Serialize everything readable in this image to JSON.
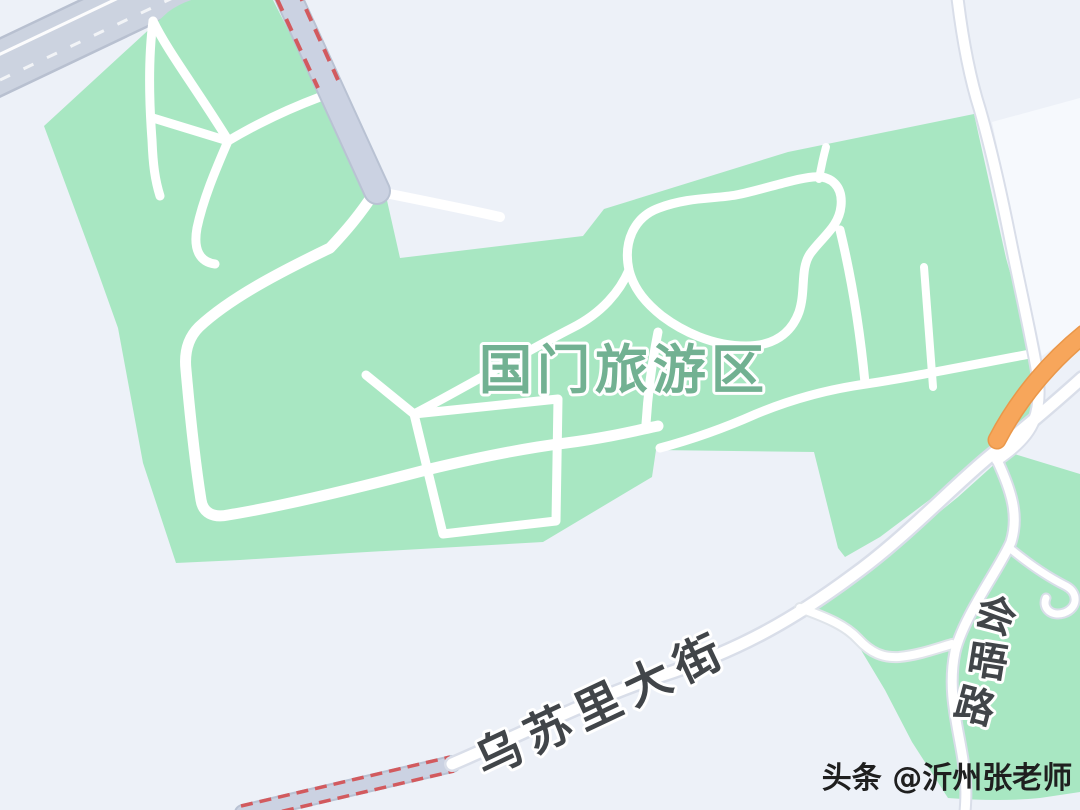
{
  "map": {
    "area_label": "国门旅游区",
    "streets": {
      "main_street": "乌苏里大街",
      "side_street": "会晤路",
      "side_street_chars": [
        "会",
        "晤",
        "路"
      ]
    },
    "watermark": "头条 @沂州张老师",
    "features": {
      "park": "tourist-area-green-zone",
      "border_strip": "red-dashed-boundary-road",
      "highway_segment": "orange-road-segment",
      "big_road": "gray-road-top-left"
    },
    "colors": {
      "background": "#edf1f8",
      "park_green": "#a8e7c2",
      "area_label_green": "#72b192",
      "street_label_dark": "#414549",
      "road_gray_fill": "#cbd2e2",
      "road_gray_casing": "#b9c2d3",
      "border_dash_red": "#d25a5e",
      "orange_road": "#f7a65b",
      "path_white": "#ffffff",
      "outer_road_casing": "#d9dee9",
      "watermark_color": "#1f1f1f"
    }
  }
}
